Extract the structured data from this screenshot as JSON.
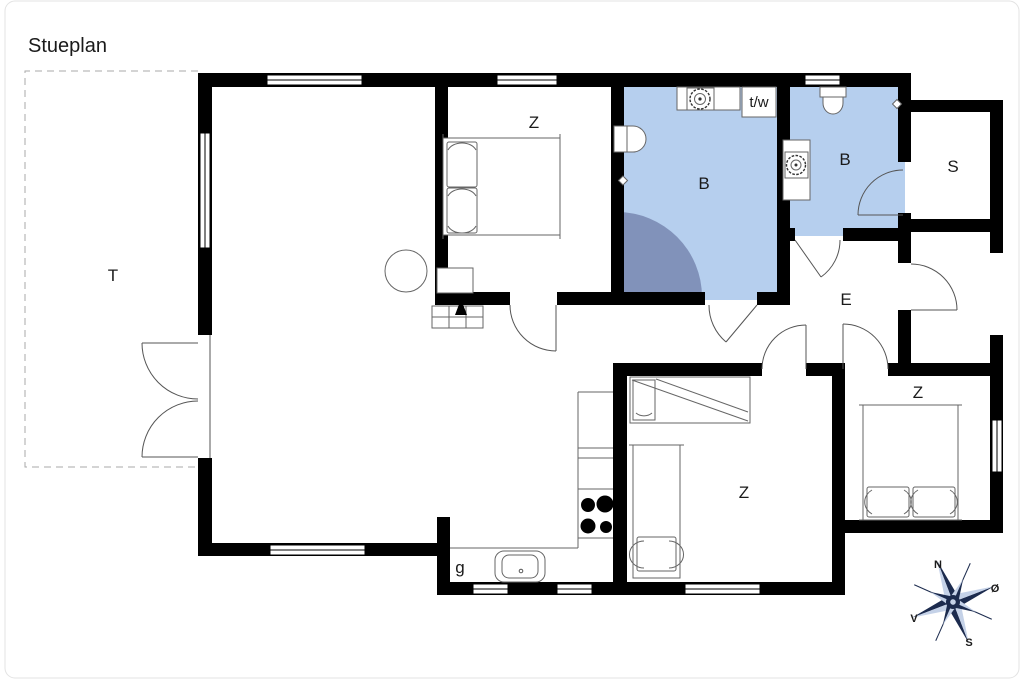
{
  "title": "Stueplan",
  "labels": {
    "terrace": "T",
    "bedroom_top": "Z",
    "bath_main": "B",
    "bath_second": "B",
    "sauna": "S",
    "entry": "E",
    "bedroom_mid": "Z",
    "bedroom_right": "Z",
    "utility": "g",
    "washer_dryer": "t/w"
  },
  "compass": {
    "n": "N",
    "e": "Ø",
    "s": "S",
    "v": "V"
  },
  "colors": {
    "wall": "#000000",
    "bath_fill": "#b6cfee",
    "shower_fill": "#8192ba",
    "shower_stroke": "#6b7ca6",
    "compass_dark": "#1c2b4e",
    "compass_light": "#c5d2e8",
    "dash": "#aaaaaa"
  }
}
